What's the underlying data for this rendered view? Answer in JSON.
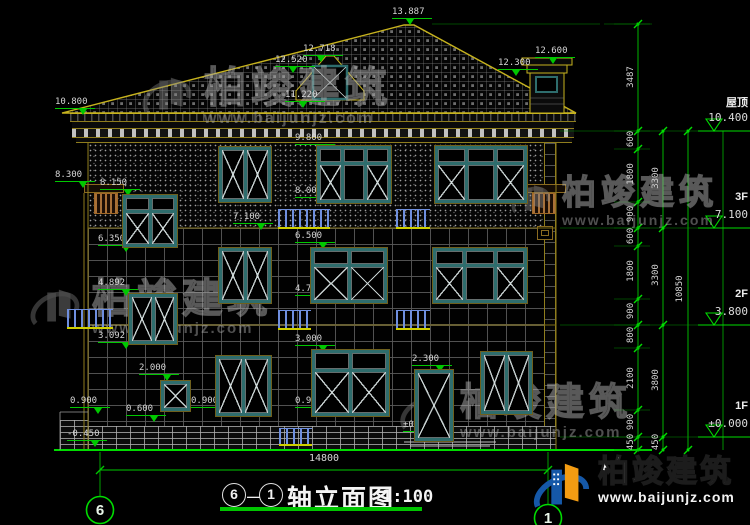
{
  "title": {
    "axis_from": "6",
    "separator": "—",
    "axis_to": "1",
    "name": "轴立面图",
    "scale": "1:100"
  },
  "bottom": {
    "total_width": "14800"
  },
  "axis_bubbles": [
    {
      "label": "6"
    },
    {
      "label": "1"
    }
  ],
  "watermark": {
    "company": "柏竣建筑",
    "url": "www.baijunjz.com"
  },
  "brand_logo": {
    "company": "柏竣建筑",
    "url": "www.baijunjz.com"
  },
  "levels": [
    {
      "name": "屋顶",
      "value": "10.400",
      "y": 131
    },
    {
      "name": "3F",
      "value": "7.100",
      "y": 228
    },
    {
      "name": "2F",
      "value": "3.800",
      "y": 325
    },
    {
      "name": "1F",
      "value": "±0.000",
      "y": 437
    }
  ],
  "spot_marks": [
    {
      "value": "13.887",
      "x": 392,
      "y": 7,
      "ta": "c"
    },
    {
      "value": "12.718",
      "x": 303,
      "y": 44,
      "ta": "c"
    },
    {
      "value": "12.520",
      "x": 275,
      "y": 55,
      "ta": "c"
    },
    {
      "value": "11.220",
      "x": 285,
      "y": 90,
      "ta": "c"
    },
    {
      "value": "12.600",
      "x": 535,
      "y": 46,
      "ta": "c"
    },
    {
      "value": "12.300",
      "x": 498,
      "y": 58,
      "ta": "c"
    },
    {
      "value": "10.800",
      "x": 55,
      "y": 97,
      "ta": "r"
    },
    {
      "value": "9.800",
      "x": 295,
      "y": 133,
      "ta": "r"
    },
    {
      "value": "8.300",
      "x": 55,
      "y": 170,
      "ta": "r"
    },
    {
      "value": "8.150",
      "x": 100,
      "y": 178,
      "ta": "r"
    },
    {
      "value": "8.000",
      "x": 295,
      "y": 186,
      "ta": "r"
    },
    {
      "value": "7.100",
      "x": 233,
      "y": 212,
      "ta": "r"
    },
    {
      "value": "6.500",
      "x": 295,
      "y": 231,
      "ta": "r"
    },
    {
      "value": "6.350",
      "x": 98,
      "y": 234,
      "ta": "r"
    },
    {
      "value": "4.892",
      "x": 98,
      "y": 278,
      "ta": "r"
    },
    {
      "value": "4.700",
      "x": 295,
      "y": 284,
      "ta": "r"
    },
    {
      "value": "3.092",
      "x": 98,
      "y": 331,
      "ta": "r"
    },
    {
      "value": "3.000",
      "x": 295,
      "y": 334,
      "ta": "r"
    },
    {
      "value": "2.300",
      "x": 412,
      "y": 354,
      "ta": "r"
    },
    {
      "value": "2.000",
      "x": 139,
      "y": 363,
      "ta": "r"
    },
    {
      "value": "0.900",
      "x": 70,
      "y": 396,
      "ta": "r"
    },
    {
      "value": "0.900",
      "x": 191,
      "y": 396,
      "ta": "r"
    },
    {
      "value": "0.900",
      "x": 295,
      "y": 396,
      "ta": "r"
    },
    {
      "value": "0.600",
      "x": 126,
      "y": 404,
      "ta": "r"
    },
    {
      "value": "±0.000",
      "x": 403,
      "y": 420,
      "ta": "c"
    },
    {
      "value": "-0.450",
      "x": 67,
      "y": 429,
      "ta": "r"
    }
  ],
  "dim_chains": [
    {
      "x": 638,
      "label_x": 631,
      "minor_ext": true,
      "ticks": [
        24,
        131,
        149,
        202,
        228,
        246,
        299,
        325,
        348,
        410,
        437,
        450
      ],
      "labels": [
        {
          "value": "3487",
          "y": 78
        },
        {
          "value": "600",
          "y": 140
        },
        {
          "value": "1800",
          "y": 175
        },
        {
          "value": "900",
          "y": 215
        },
        {
          "value": "600",
          "y": 237
        },
        {
          "value": "1800",
          "y": 272
        },
        {
          "value": "900",
          "y": 312
        },
        {
          "value": "800",
          "y": 336
        },
        {
          "value": "2100",
          "y": 379
        },
        {
          "value": "900",
          "y": 423
        },
        {
          "value": "450",
          "y": 443
        }
      ]
    },
    {
      "x": 663,
      "label_x": 656,
      "minor_ext": false,
      "ticks": [
        131,
        228,
        325,
        437,
        450
      ],
      "labels": [
        {
          "value": "3300",
          "y": 179
        },
        {
          "value": "3300",
          "y": 276
        },
        {
          "value": "3800",
          "y": 381
        },
        {
          "value": "450",
          "y": 443
        }
      ]
    },
    {
      "x": 688,
      "label_x": 680,
      "minor_ext": false,
      "ticks": [
        131,
        450
      ],
      "labels": [
        {
          "value": "10850",
          "y": 290
        }
      ]
    }
  ],
  "facade": {
    "windows": [
      {
        "x": 218,
        "y": 146,
        "w": 54,
        "h": 57,
        "t": "2x"
      },
      {
        "x": 316,
        "y": 145,
        "w": 76,
        "h": 59,
        "t": "t3"
      },
      {
        "x": 434,
        "y": 145,
        "w": 94,
        "h": 59,
        "t": "t3"
      },
      {
        "x": 122,
        "y": 194,
        "w": 56,
        "h": 54,
        "t": "t2"
      },
      {
        "x": 128,
        "y": 293,
        "w": 50,
        "h": 52,
        "t": "2x"
      },
      {
        "x": 160,
        "y": 380,
        "w": 31,
        "h": 32,
        "t": "1x"
      },
      {
        "x": 218,
        "y": 247,
        "w": 54,
        "h": 57,
        "t": "2x"
      },
      {
        "x": 310,
        "y": 247,
        "w": 78,
        "h": 57,
        "t": "t2"
      },
      {
        "x": 432,
        "y": 247,
        "w": 96,
        "h": 57,
        "t": "t3"
      },
      {
        "x": 215,
        "y": 355,
        "w": 57,
        "h": 62,
        "t": "2x"
      },
      {
        "x": 311,
        "y": 349,
        "w": 79,
        "h": 68,
        "t": "t2"
      },
      {
        "x": 480,
        "y": 351,
        "w": 53,
        "h": 64,
        "t": "2x"
      },
      {
        "x": 414,
        "y": 369,
        "w": 40,
        "h": 73,
        "t": "door"
      }
    ],
    "railings": [
      {
        "x": 278,
        "y": 209,
        "w": 52,
        "h": 20
      },
      {
        "x": 396,
        "y": 209,
        "w": 34,
        "h": 20
      },
      {
        "x": 67,
        "y": 309,
        "w": 46,
        "h": 20
      },
      {
        "x": 278,
        "y": 310,
        "w": 33,
        "h": 20
      },
      {
        "x": 396,
        "y": 310,
        "w": 34,
        "h": 20
      },
      {
        "x": 279,
        "y": 428,
        "w": 33,
        "h": 18
      }
    ]
  }
}
